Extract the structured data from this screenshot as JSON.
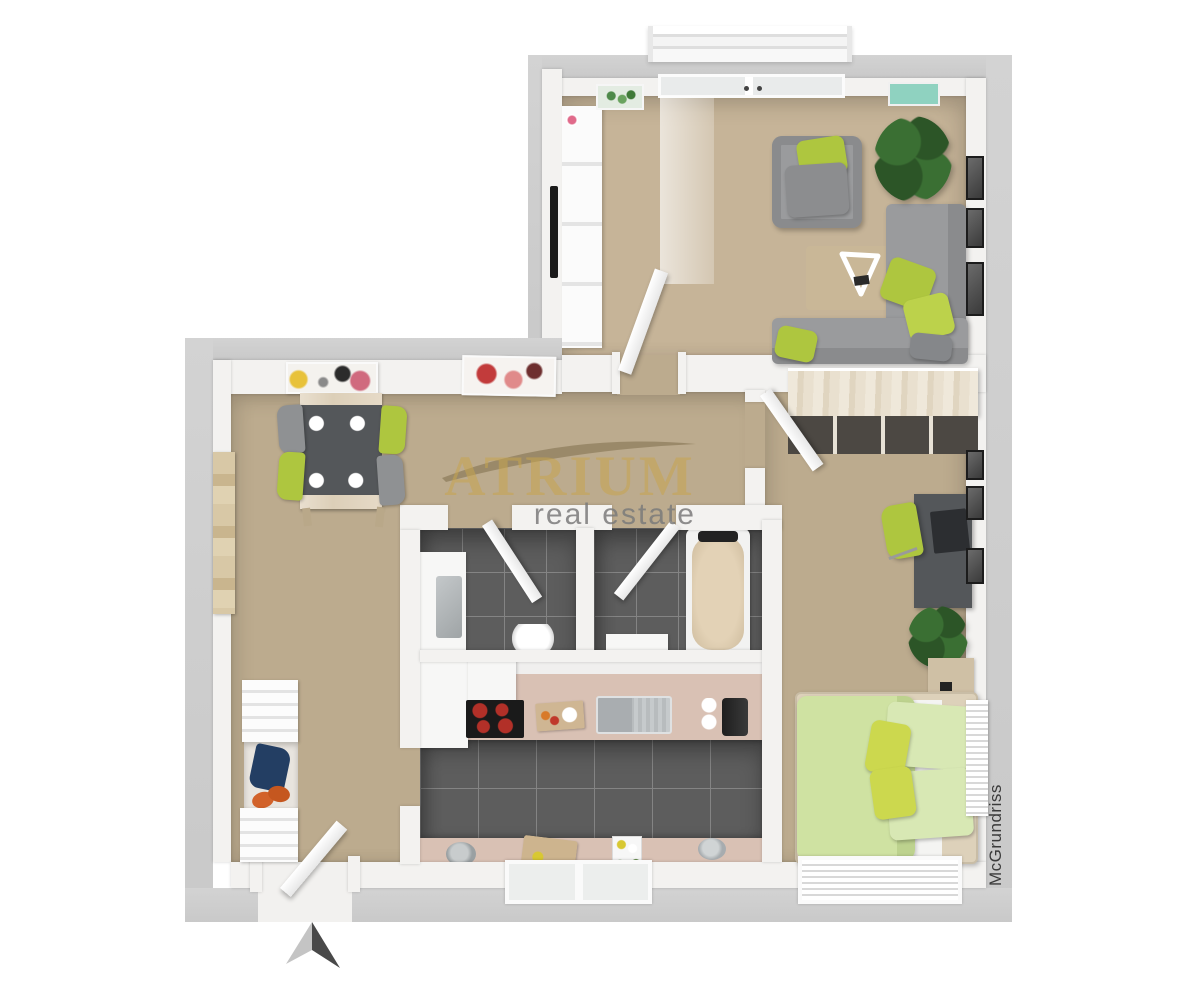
{
  "watermark": {
    "brand": "ATRIUM",
    "tagline": "real estate"
  },
  "side_label": "McGrundriss",
  "compass": {
    "direction": "north"
  },
  "colors": {
    "wall_outer": "#c9c9c9",
    "wall_inner": "#f3f2f0",
    "carpet": "#bcab8e",
    "carpet_light": "#c6b498",
    "tile_dark": "#5d5d5d",
    "tile_grout": "#848484",
    "counter": "#d9c1b4",
    "wood_pale": "#ddd1ba",
    "wood_mid": "#cfc0a5",
    "green": "#aec63f",
    "green_light": "#cfe2a2",
    "green_pale": "#d8e8b4",
    "yellow_green": "#ccd84e",
    "sofa": "#9a9b9d",
    "sofa_dark": "#8a8b8d",
    "furn_dark": "#54575a",
    "black": "#1a1a1a",
    "plant": "#3a6f33",
    "plant_dark": "#2c5527",
    "orange": "#d2622a",
    "navy": "#233e63",
    "burner": "#b23028",
    "steel": "#c6cacc",
    "teal": "#8fd2c0",
    "pink": "#e06a8a",
    "white_furn": "#f7f7f6",
    "label_dark": "#3a3a3a",
    "arrow_light": "#c4c4c4",
    "arrow_dark": "#494949"
  },
  "scene": {
    "type": "3d-floor-plan-render",
    "rooms": [
      {
        "name": "living-room",
        "items": [
          "corner-sofa",
          "armchair",
          "green-pillows",
          "tripod-coffee-table",
          "rug",
          "tv-sideboard",
          "tv",
          "potted-plant",
          "picture-frames",
          "balcony-window",
          "curtain",
          "botanical-wall-art",
          "teal-wall-art"
        ]
      },
      {
        "name": "dining-hall",
        "items": [
          "dining-table",
          "plates",
          "green-chairs",
          "gray-chairs",
          "abstract-wall-art-1",
          "abstract-wall-art-2",
          "wall-hanging"
        ]
      },
      {
        "name": "wc",
        "items": [
          "vanity-sink",
          "toilet",
          "door"
        ]
      },
      {
        "name": "bathroom",
        "items": [
          "bathtub",
          "cabinet",
          "door"
        ]
      },
      {
        "name": "kitchen",
        "items": [
          "fridge",
          "extractor-hood",
          "cooktop",
          "cutting-boards",
          "sink",
          "coffee-machine",
          "counters",
          "bowls",
          "bottle-tray",
          "window"
        ]
      },
      {
        "name": "bedroom",
        "items": [
          "wardrobe",
          "desk",
          "laptop",
          "office-chair",
          "picture-frames",
          "potted-plant",
          "nightstand",
          "double-bed",
          "pillows",
          "radiator",
          "window",
          "door"
        ]
      },
      {
        "name": "entry-hall",
        "items": [
          "coat-rack",
          "jacket",
          "shoes",
          "entry-door",
          "north-arrow"
        ]
      }
    ]
  }
}
